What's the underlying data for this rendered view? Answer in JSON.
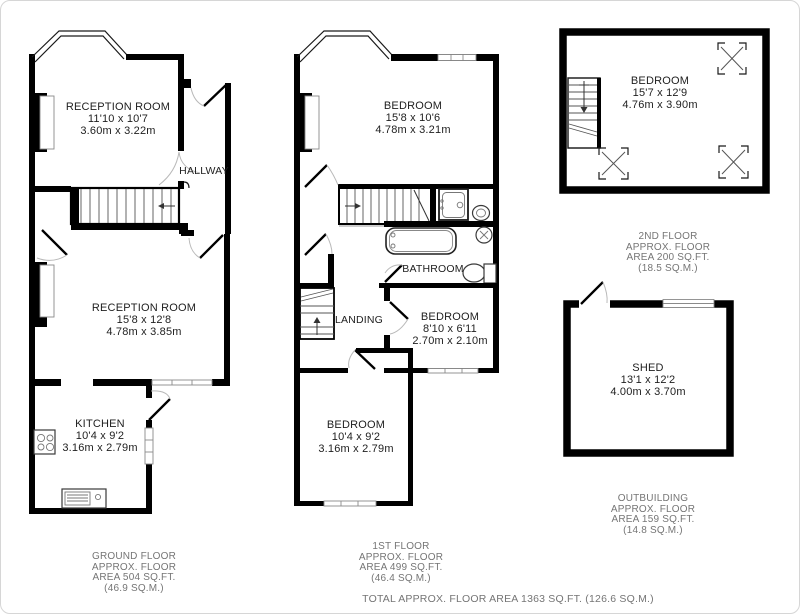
{
  "floors": {
    "ground": {
      "rooms": {
        "reception_front": {
          "name": "RECEPTION ROOM",
          "imperial": "11'10 x 10'7",
          "metric": "3.60m x 3.22m"
        },
        "hallway": {
          "name": "HALLWAY"
        },
        "reception_rear": {
          "name": "RECEPTION ROOM",
          "imperial": "15'8 x 12'8",
          "metric": "4.78m x 3.85m"
        },
        "kitchen": {
          "name": "KITCHEN",
          "imperial": "10'4 x 9'2",
          "metric": "3.16m x 2.79m"
        }
      },
      "label": [
        "GROUND FLOOR",
        "APPROX. FLOOR",
        "AREA 504 SQ.FT.",
        "(46.9 SQ.M.)"
      ]
    },
    "first": {
      "rooms": {
        "bedroom_front": {
          "name": "BEDROOM",
          "imperial": "15'8 x 10'6",
          "metric": "4.78m x 3.21m"
        },
        "bathroom": {
          "name": "BATHROOM"
        },
        "landing": {
          "name": "LANDING"
        },
        "bedroom_middle": {
          "name": "BEDROOM",
          "imperial": "8'10 x 6'11",
          "metric": "2.70m x 2.10m"
        },
        "bedroom_rear": {
          "name": "BEDROOM",
          "imperial": "10'4 x 9'2",
          "metric": "3.16m x 2.79m"
        }
      },
      "label": [
        "1ST FLOOR",
        "APPROX. FLOOR",
        "AREA 499 SQ.FT.",
        "(46.4 SQ.M.)"
      ]
    },
    "second": {
      "rooms": {
        "bedroom": {
          "name": "BEDROOM",
          "imperial": "15'7 x 12'9",
          "metric": "4.76m x 3.90m"
        }
      },
      "label": [
        "2ND FLOOR",
        "APPROX. FLOOR",
        "AREA 200 SQ.FT.",
        "(18.5 SQ.M.)"
      ]
    },
    "outbuilding": {
      "rooms": {
        "shed": {
          "name": "SHED",
          "imperial": "13'1 x 12'2",
          "metric": "4.00m x 3.70m"
        }
      },
      "label": [
        "OUTBUILDING",
        "APPROX. FLOOR",
        "AREA 159 SQ.FT.",
        "(14.8 SQ.M.)"
      ]
    }
  },
  "total_label": "TOTAL APPROX. FLOOR AREA 1363 SQ.FT. (126.6 SQ.M.)"
}
